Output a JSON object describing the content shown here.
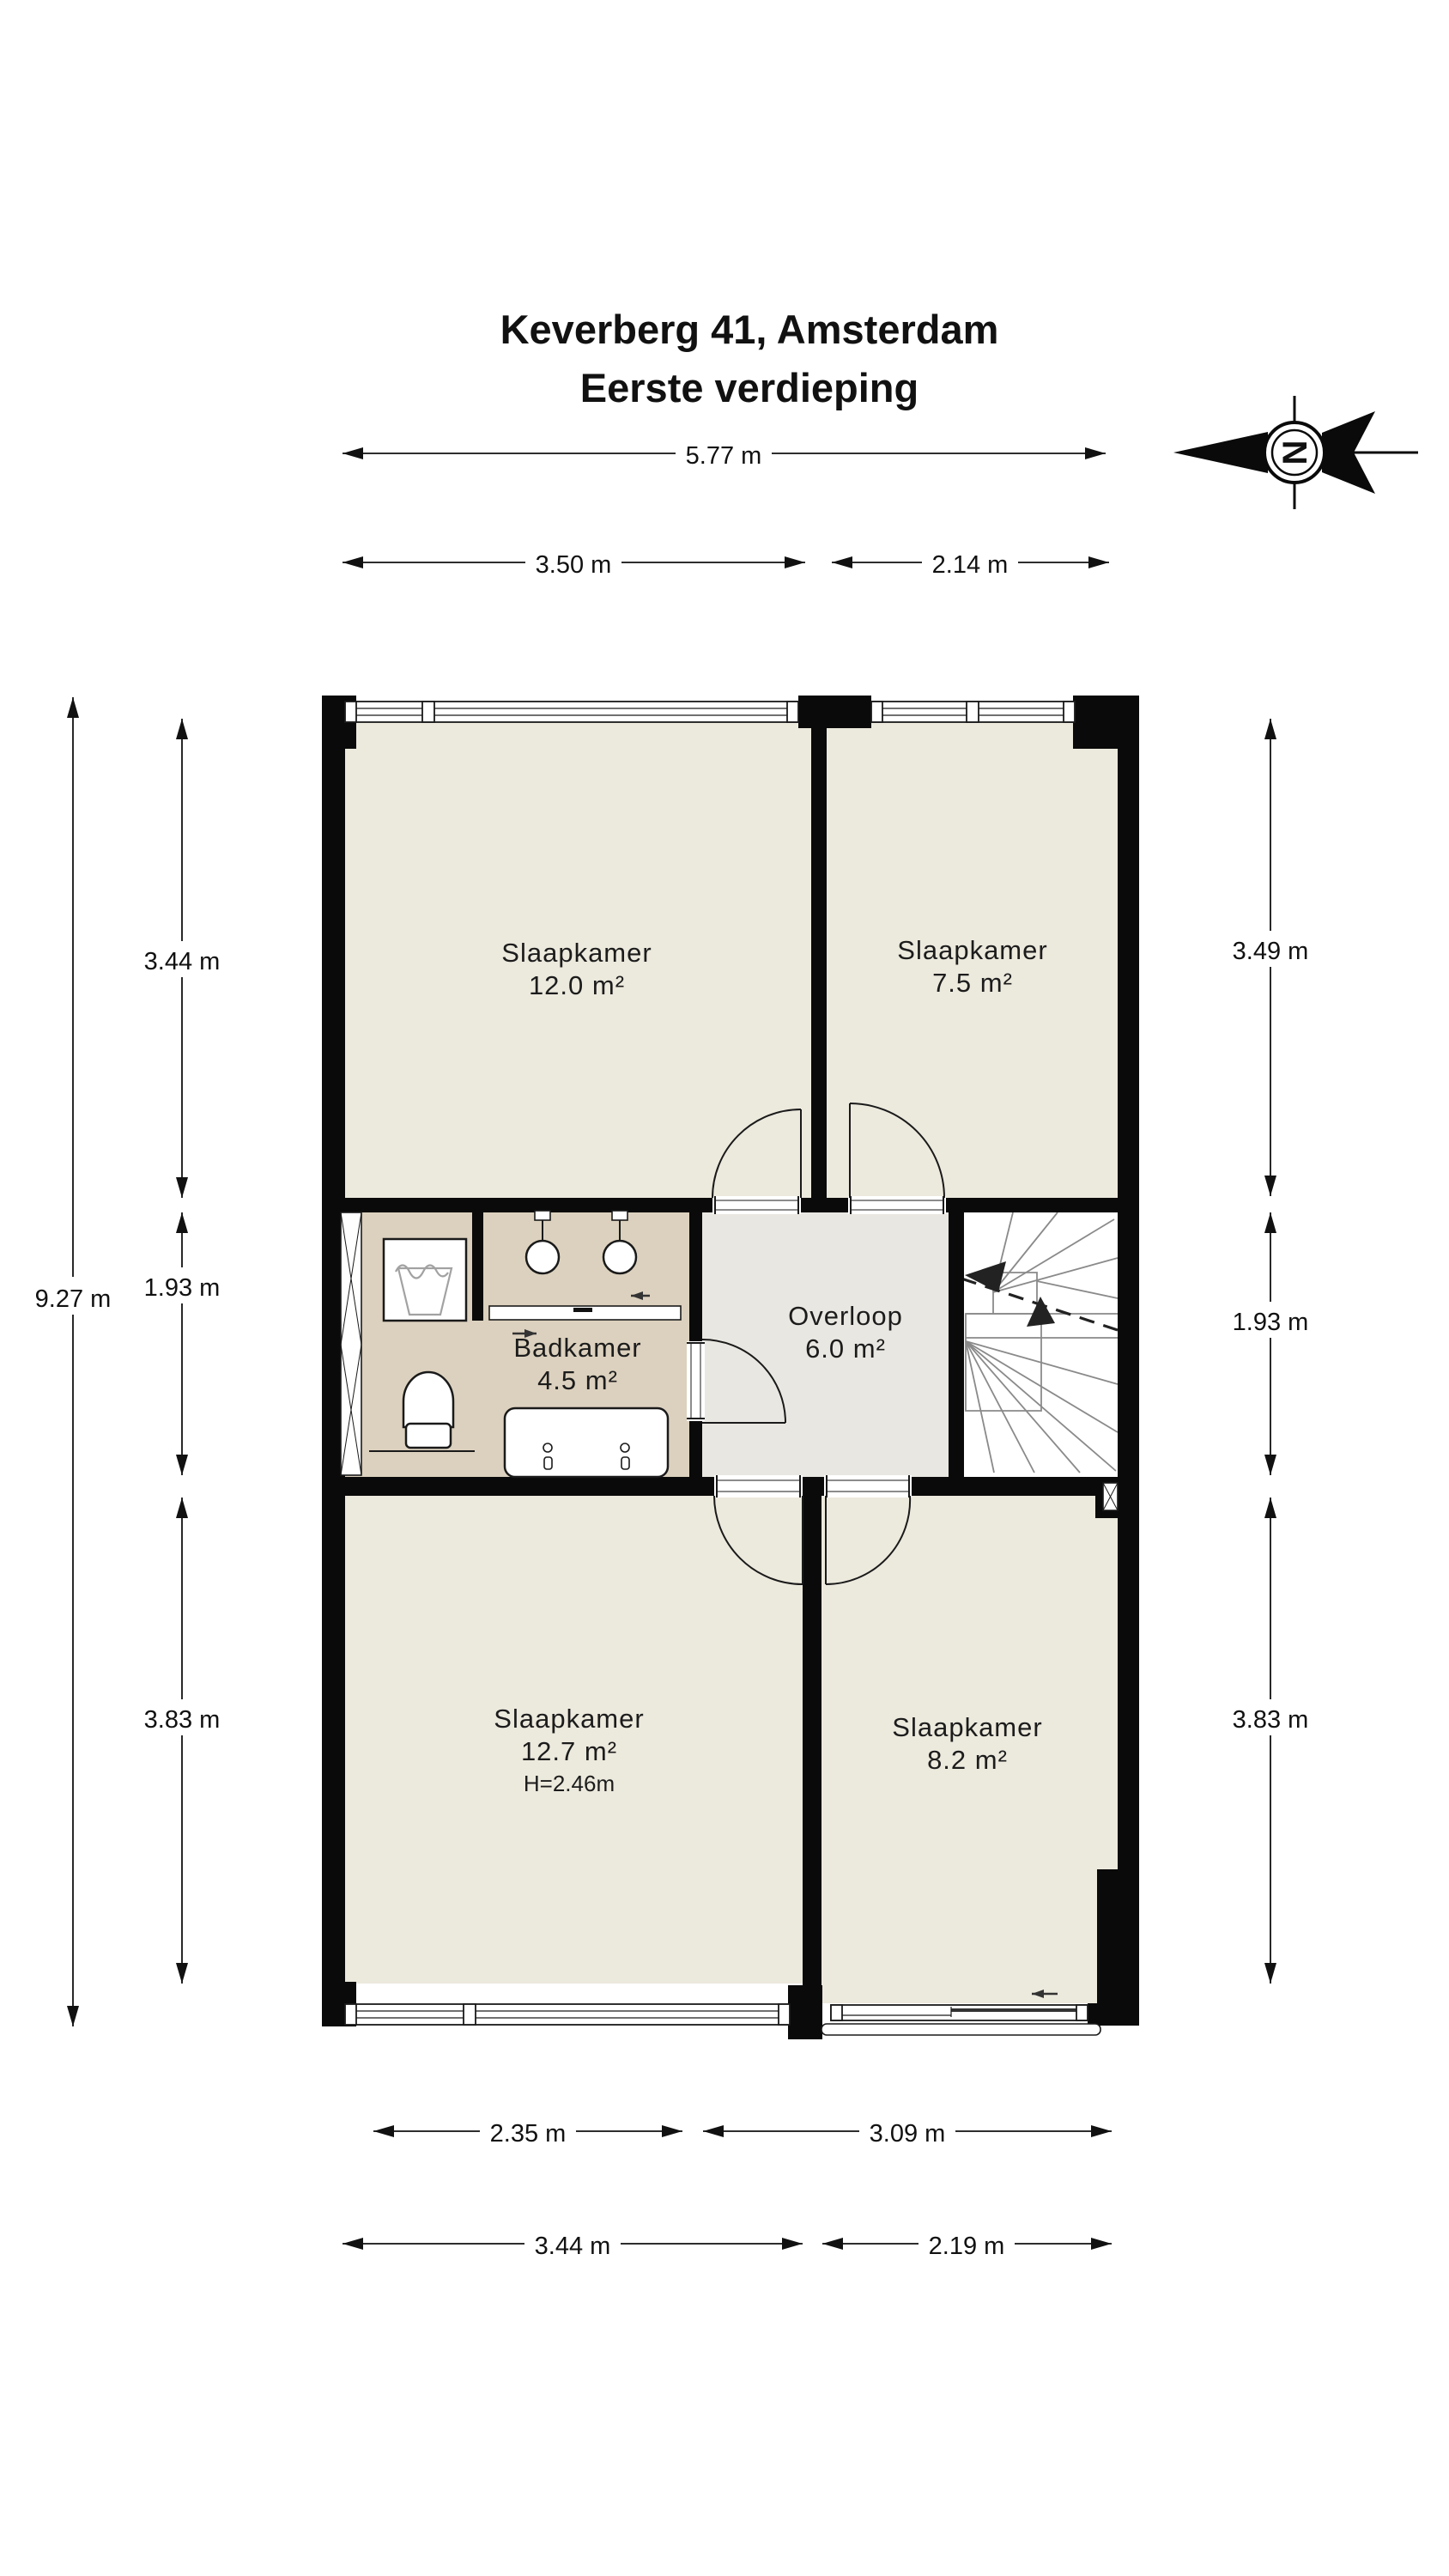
{
  "title": {
    "line1": "Keverberg 41, Amsterdam",
    "line2": "Eerste verdieping"
  },
  "compass": {
    "letter": "N"
  },
  "rooms": [
    {
      "id": "slaapkamer-12-0",
      "name": "Slaapkamer",
      "area": "12.0 m²"
    },
    {
      "id": "slaapkamer-7-5",
      "name": "Slaapkamer",
      "area": "7.5 m²"
    },
    {
      "id": "badkamer",
      "name": "Badkamer",
      "area": "4.5 m²"
    },
    {
      "id": "overloop",
      "name": "Overloop",
      "area": "6.0 m²"
    },
    {
      "id": "slaapkamer-12-7",
      "name": "Slaapkamer",
      "area": "12.7 m²",
      "ceiling_height": "H=2.46m"
    },
    {
      "id": "slaapkamer-8-2",
      "name": "Slaapkamer",
      "area": "8.2 m²"
    }
  ],
  "dimensions": {
    "top_total": "5.77 m",
    "top_left": "3.50 m",
    "top_right": "2.14 m",
    "left_total": "9.27 m",
    "left_top": "3.44 m",
    "left_middle": "1.93 m",
    "left_bottom": "3.83 m",
    "right_top": "3.49 m",
    "right_middle": "1.93 m",
    "right_bottom": "3.83 m",
    "bottom_inner_left": "2.35 m",
    "bottom_inner_right": "3.09 m",
    "bottom_outer_left": "3.44 m",
    "bottom_outer_right": "2.19 m"
  },
  "colors": {
    "wall": "#0a0a0a",
    "line": "#1a1a1a",
    "bedroom": "#ece9dd",
    "bathroom": "#dcd1be",
    "landing": "#e9e7e1",
    "tread": "#8a8a8a"
  }
}
